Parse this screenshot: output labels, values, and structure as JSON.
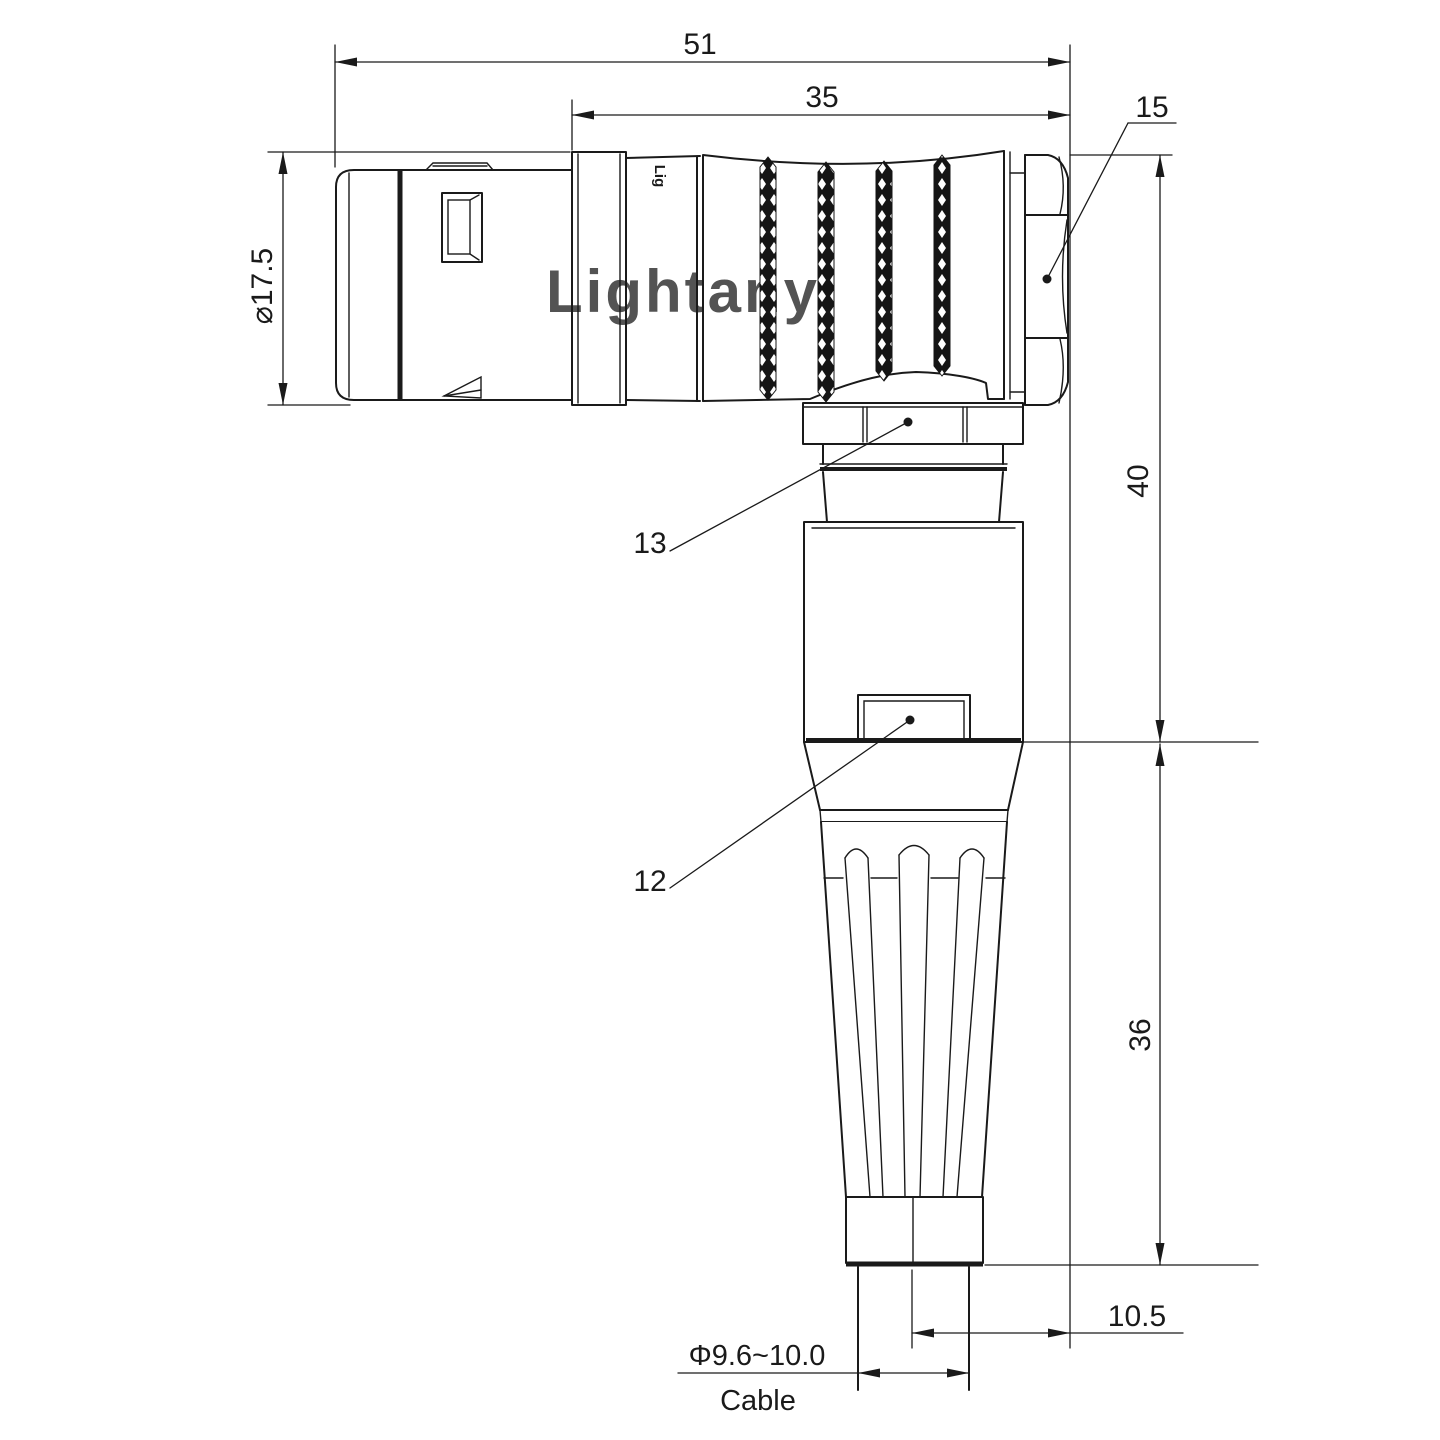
{
  "drawing": {
    "background": "#ffffff",
    "line_color": "#1a1a1a",
    "watermark": {
      "text": "Lightany",
      "color": "#f2c9c9"
    },
    "engraving": {
      "text": "Lig"
    },
    "dimensions": {
      "total_length": "51",
      "boot_length": "35",
      "hex_nut_callout": "15",
      "plug_diameter": "⌀17.5",
      "upper_height": "40",
      "lower_height": "36",
      "collar_callout": "13",
      "latch_callout": "12",
      "axis_offset": "10.5",
      "cable_diameter": "Φ9.6~10.0",
      "cable_label": "Cable"
    }
  }
}
